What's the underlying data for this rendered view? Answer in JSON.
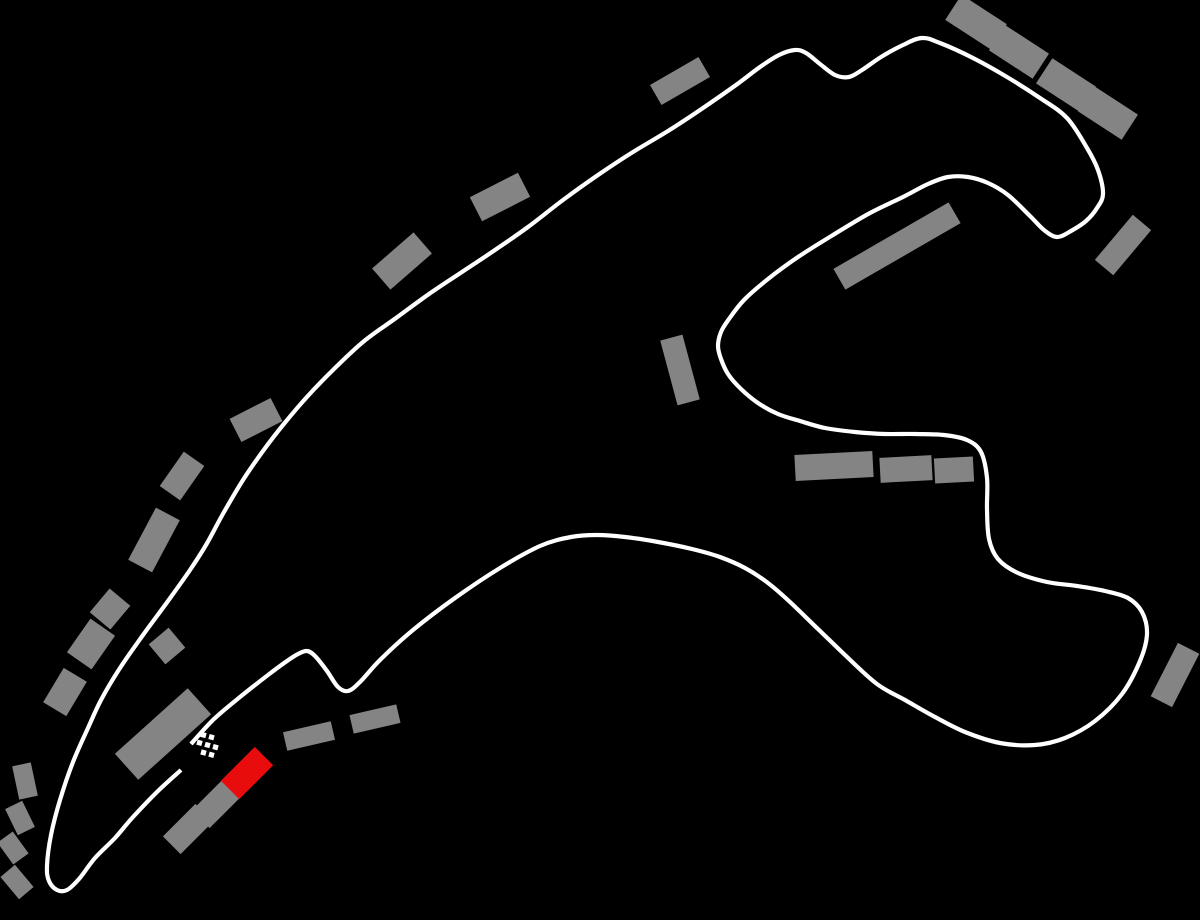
{
  "title": "Race circuit track map",
  "colors": {
    "background": "#000000",
    "track": "#ffffff",
    "grandstand": "#848484",
    "highlight_grandstand": "#e80c0c",
    "flag": "#ffffff"
  },
  "map": {
    "width": 1200,
    "height": 920,
    "track": {
      "stroke_width": 4.2,
      "points": [
        [
          191,
          744
        ],
        [
          214,
          719
        ],
        [
          240,
          697
        ],
        [
          268,
          675
        ],
        [
          287,
          661
        ],
        [
          298,
          654
        ],
        [
          307,
          651
        ],
        [
          315,
          656
        ],
        [
          327,
          671
        ],
        [
          338,
          687
        ],
        [
          348,
          691
        ],
        [
          360,
          682
        ],
        [
          380,
          660
        ],
        [
          413,
          630
        ],
        [
          455,
          598
        ],
        [
          500,
          568
        ],
        [
          540,
          546
        ],
        [
          571,
          537
        ],
        [
          597,
          535
        ],
        [
          625,
          537
        ],
        [
          658,
          542
        ],
        [
          692,
          549
        ],
        [
          720,
          557
        ],
        [
          745,
          568
        ],
        [
          768,
          583
        ],
        [
          790,
          602
        ],
        [
          818,
          629
        ],
        [
          845,
          655
        ],
        [
          877,
          684
        ],
        [
          905,
          700
        ],
        [
          935,
          717
        ],
        [
          965,
          732
        ],
        [
          1000,
          743
        ],
        [
          1035,
          745
        ],
        [
          1065,
          738
        ],
        [
          1095,
          721
        ],
        [
          1122,
          694
        ],
        [
          1140,
          661
        ],
        [
          1147,
          634
        ],
        [
          1142,
          612
        ],
        [
          1128,
          598
        ],
        [
          1105,
          591
        ],
        [
          1077,
          586
        ],
        [
          1047,
          582
        ],
        [
          1018,
          573
        ],
        [
          998,
          559
        ],
        [
          989,
          539
        ],
        [
          987,
          509
        ],
        [
          987,
          478
        ],
        [
          981,
          452
        ],
        [
          967,
          440
        ],
        [
          944,
          435
        ],
        [
          915,
          434
        ],
        [
          885,
          434
        ],
        [
          855,
          432
        ],
        [
          825,
          428
        ],
        [
          800,
          421
        ],
        [
          778,
          414
        ],
        [
          758,
          403
        ],
        [
          741,
          389
        ],
        [
          728,
          374
        ],
        [
          721,
          359
        ],
        [
          718,
          346
        ],
        [
          721,
          332
        ],
        [
          729,
          319
        ],
        [
          744,
          300
        ],
        [
          768,
          279
        ],
        [
          798,
          257
        ],
        [
          833,
          235
        ],
        [
          870,
          213
        ],
        [
          903,
          197
        ],
        [
          928,
          184
        ],
        [
          948,
          177
        ],
        [
          968,
          177
        ],
        [
          988,
          183
        ],
        [
          1008,
          195
        ],
        [
          1030,
          216
        ],
        [
          1044,
          230
        ],
        [
          1057,
          237
        ],
        [
          1071,
          231
        ],
        [
          1086,
          221
        ],
        [
          1097,
          208
        ],
        [
          1103,
          194
        ],
        [
          1098,
          170
        ],
        [
          1087,
          148
        ],
        [
          1067,
          118
        ],
        [
          1040,
          98
        ],
        [
          1007,
          77
        ],
        [
          973,
          58
        ],
        [
          940,
          43
        ],
        [
          922,
          38
        ],
        [
          903,
          45
        ],
        [
          881,
          57
        ],
        [
          862,
          70
        ],
        [
          849,
          77
        ],
        [
          835,
          75
        ],
        [
          820,
          64
        ],
        [
          806,
          53
        ],
        [
          795,
          50
        ],
        [
          779,
          55
        ],
        [
          760,
          67
        ],
        [
          736,
          85
        ],
        [
          703,
          108
        ],
        [
          668,
          131
        ],
        [
          633,
          152
        ],
        [
          598,
          175
        ],
        [
          563,
          200
        ],
        [
          528,
          227
        ],
        [
          495,
          250
        ],
        [
          462,
          272
        ],
        [
          429,
          294
        ],
        [
          396,
          318
        ],
        [
          363,
          342
        ],
        [
          333,
          370
        ],
        [
          306,
          398
        ],
        [
          283,
          425
        ],
        [
          263,
          451
        ],
        [
          243,
          480
        ],
        [
          224,
          512
        ],
        [
          206,
          545
        ],
        [
          190,
          570
        ],
        [
          168,
          601
        ],
        [
          143,
          635
        ],
        [
          120,
          668
        ],
        [
          101,
          700
        ],
        [
          88,
          728
        ],
        [
          73,
          762
        ],
        [
          60,
          800
        ],
        [
          51,
          835
        ],
        [
          47,
          866
        ],
        [
          49,
          881
        ],
        [
          57,
          890
        ],
        [
          67,
          890
        ],
        [
          79,
          879
        ],
        [
          95,
          858
        ],
        [
          115,
          838
        ],
        [
          133,
          817
        ],
        [
          158,
          791
        ],
        [
          181,
          770
        ]
      ]
    },
    "start_finish_flag": {
      "square_size": 5.2,
      "rotation": 15,
      "squares": [
        [
          203.5,
          735.0
        ],
        [
          211.5,
          737.2
        ],
        [
          199.5,
          742.8
        ],
        [
          207.5,
          745.0
        ],
        [
          215.5,
          747.2
        ],
        [
          203.5,
          752.6
        ],
        [
          211.5,
          754.8
        ]
      ]
    },
    "grandstands": [
      {
        "x": 680,
        "y": 81,
        "w": 56,
        "h": 23,
        "r": -30,
        "highlight": false
      },
      {
        "x": 500,
        "y": 197,
        "w": 54,
        "h": 27,
        "r": -27,
        "highlight": false
      },
      {
        "x": 402,
        "y": 261,
        "w": 55,
        "h": 28,
        "r": -41,
        "highlight": false
      },
      {
        "x": 256,
        "y": 420,
        "w": 46,
        "h": 26,
        "r": -27,
        "highlight": false
      },
      {
        "x": 182,
        "y": 476,
        "w": 42,
        "h": 25,
        "r": -55,
        "highlight": false
      },
      {
        "x": 154,
        "y": 540,
        "w": 59,
        "h": 27,
        "r": -62,
        "highlight": false
      },
      {
        "x": 110,
        "y": 609,
        "w": 31,
        "h": 27,
        "r": -50,
        "highlight": false
      },
      {
        "x": 91,
        "y": 644,
        "w": 41,
        "h": 30,
        "r": -55,
        "highlight": false
      },
      {
        "x": 65,
        "y": 692,
        "w": 40,
        "h": 27,
        "r": -59,
        "highlight": false
      },
      {
        "x": 167,
        "y": 646,
        "w": 26,
        "h": 26,
        "r": -40,
        "highlight": false
      },
      {
        "x": 25,
        "y": 781,
        "w": 34,
        "h": 19,
        "r": 78,
        "highlight": false
      },
      {
        "x": 20,
        "y": 818,
        "w": 29,
        "h": 19,
        "r": 64,
        "highlight": false
      },
      {
        "x": 13,
        "y": 848,
        "w": 27,
        "h": 19,
        "r": 54,
        "highlight": false
      },
      {
        "x": 17,
        "y": 882,
        "w": 29,
        "h": 19,
        "r": 50,
        "highlight": false
      },
      {
        "x": 163,
        "y": 734,
        "w": 98,
        "h": 35,
        "r": -42,
        "highlight": false
      },
      {
        "x": 188,
        "y": 829,
        "w": 46,
        "h": 25,
        "r": -45,
        "highlight": false
      },
      {
        "x": 217,
        "y": 803,
        "w": 46,
        "h": 25,
        "r": -45,
        "highlight": false
      },
      {
        "x": 247,
        "y": 773,
        "w": 48,
        "h": 26,
        "r": -45,
        "highlight": true
      },
      {
        "x": 309,
        "y": 736,
        "w": 49,
        "h": 19,
        "r": -13,
        "highlight": false
      },
      {
        "x": 375,
        "y": 719,
        "w": 48,
        "h": 19,
        "r": -13,
        "highlight": false
      },
      {
        "x": 897,
        "y": 246,
        "w": 133,
        "h": 24,
        "r": -30,
        "highlight": false
      },
      {
        "x": 834,
        "y": 466,
        "w": 78,
        "h": 26,
        "r": -3,
        "highlight": false
      },
      {
        "x": 906,
        "y": 469,
        "w": 52,
        "h": 25,
        "r": -3,
        "highlight": false
      },
      {
        "x": 954,
        "y": 470,
        "w": 39,
        "h": 25,
        "r": -3,
        "highlight": false
      },
      {
        "x": 680,
        "y": 370,
        "w": 67,
        "h": 23,
        "r": 75,
        "highlight": false
      },
      {
        "x": 1123,
        "y": 245,
        "w": 59,
        "h": 24,
        "r": -50,
        "highlight": false
      },
      {
        "x": 976,
        "y": 22,
        "w": 54,
        "h": 30,
        "r": 33,
        "highlight": false
      },
      {
        "x": 1019,
        "y": 52,
        "w": 52,
        "h": 30,
        "r": 33,
        "highlight": false
      },
      {
        "x": 1066,
        "y": 85,
        "w": 52,
        "h": 30,
        "r": 33,
        "highlight": false
      },
      {
        "x": 1108,
        "y": 113,
        "w": 52,
        "h": 30,
        "r": 33,
        "highlight": false
      },
      {
        "x": 1175,
        "y": 675,
        "w": 60,
        "h": 24,
        "r": -63,
        "highlight": false
      }
    ]
  }
}
